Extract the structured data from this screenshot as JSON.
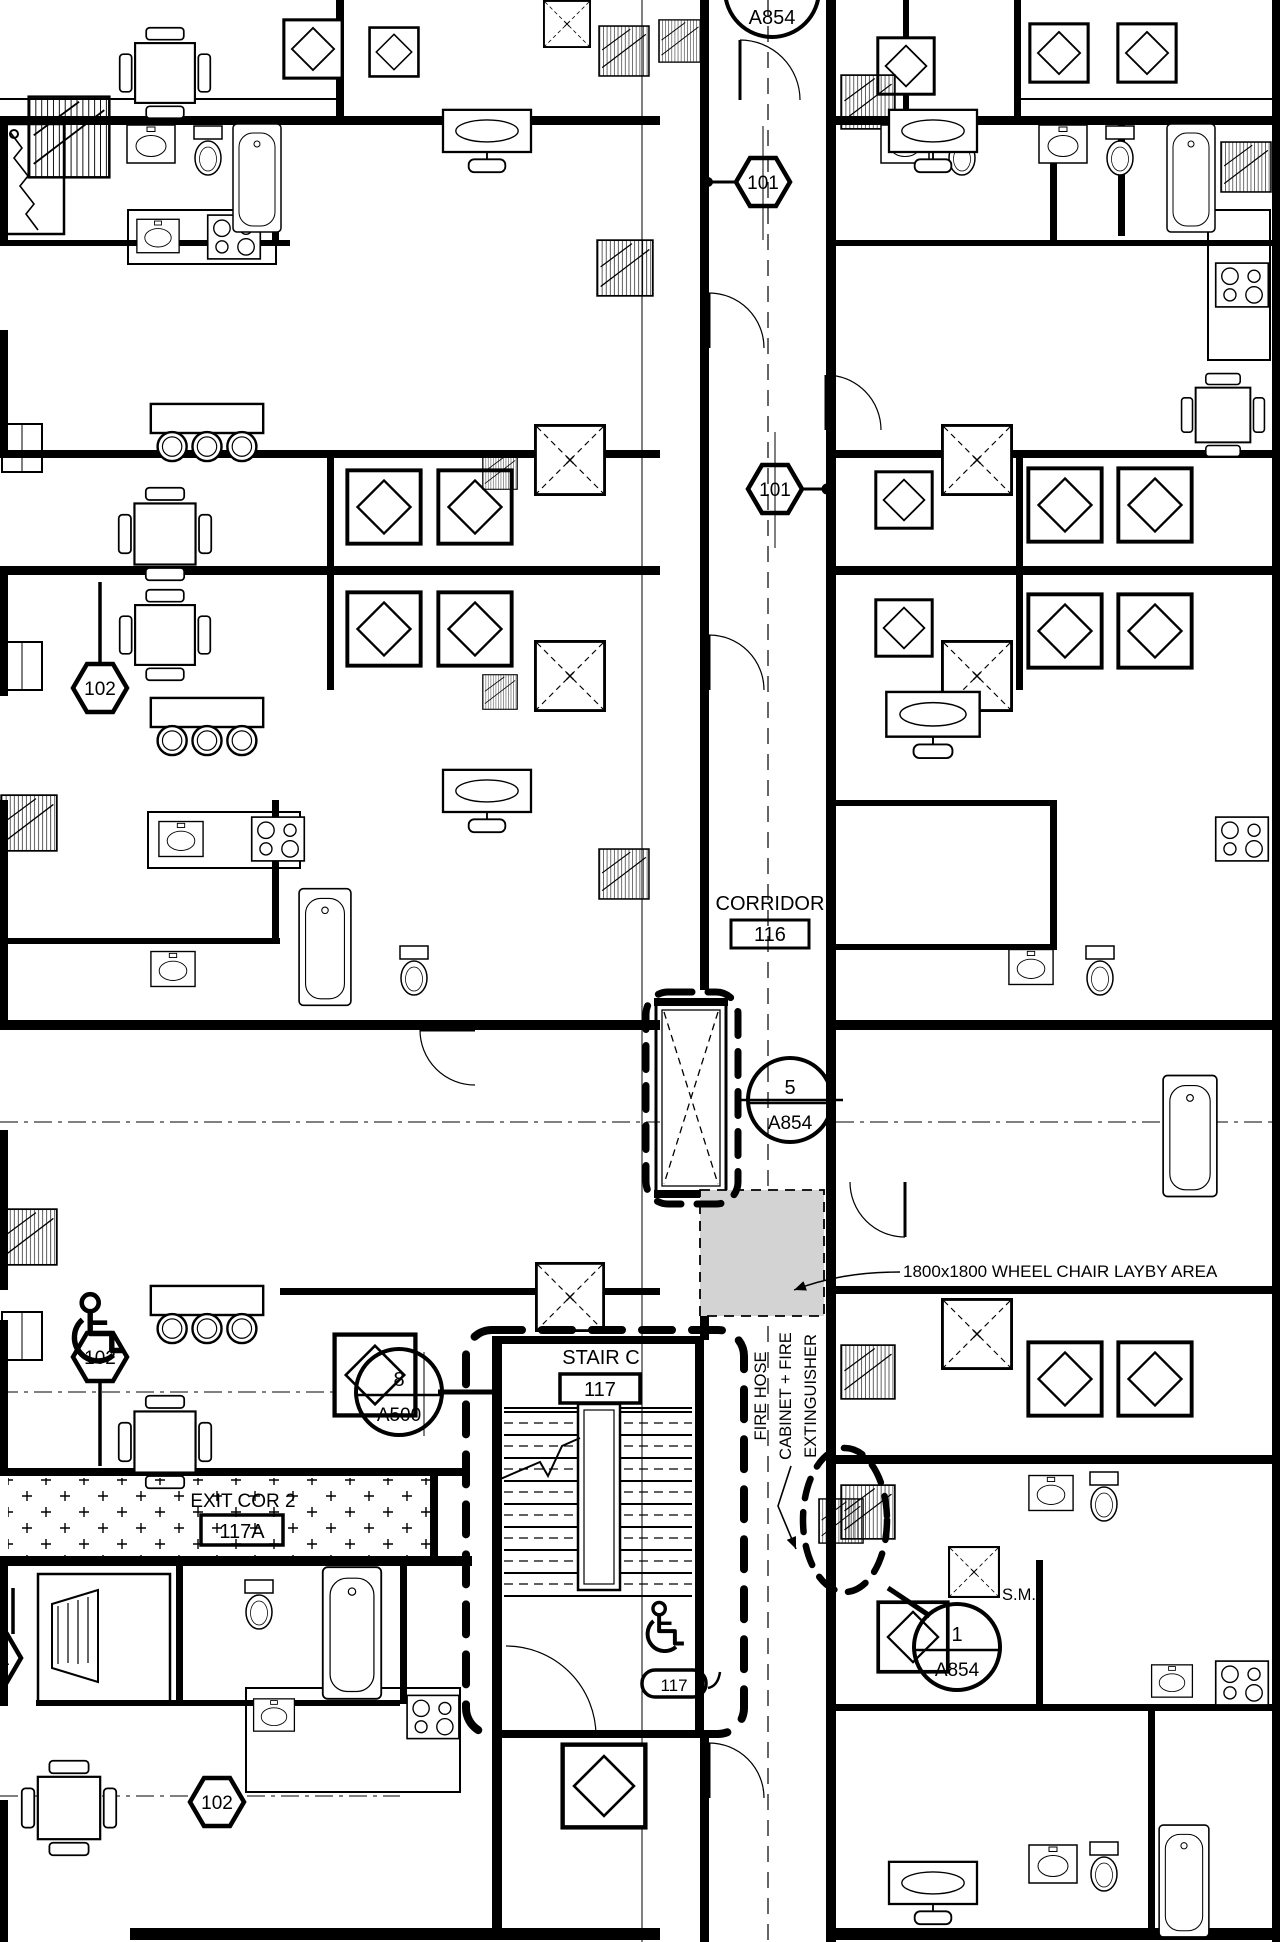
{
  "labels": {
    "corridor_name": "CORRIDOR",
    "corridor_num": "116",
    "stair_name": "STAIR C",
    "stair_num": "117",
    "exit_name": "EXIT COR 2",
    "exit_num": "117A",
    "stair_door_tag": "117",
    "layby_note": "1800x1800 WHEEL CHAIR LAYBY AREA",
    "fire_note_l1": "FIRE HOSE",
    "fire_note_l2": "CABINET + FIRE",
    "fire_note_l3": "EXTINGUISHER",
    "sim_note": "S.M."
  },
  "detail_markers": {
    "top_sheet": "A854",
    "corridor": {
      "num": "5",
      "sheet": "A854"
    },
    "stair": {
      "num": "8",
      "sheet": "A500"
    },
    "cabinet": {
      "num": "1",
      "sheet": "A854"
    }
  },
  "grid_tags": {
    "t101_top": "101",
    "t101_mid": "101",
    "t101_left": "101",
    "t102_upper": "102",
    "t102_lower": "102",
    "t102_bottom": "102"
  },
  "colors": {
    "line": "#000000",
    "layby_fill": "#d3d3d3",
    "background": "#ffffff"
  }
}
